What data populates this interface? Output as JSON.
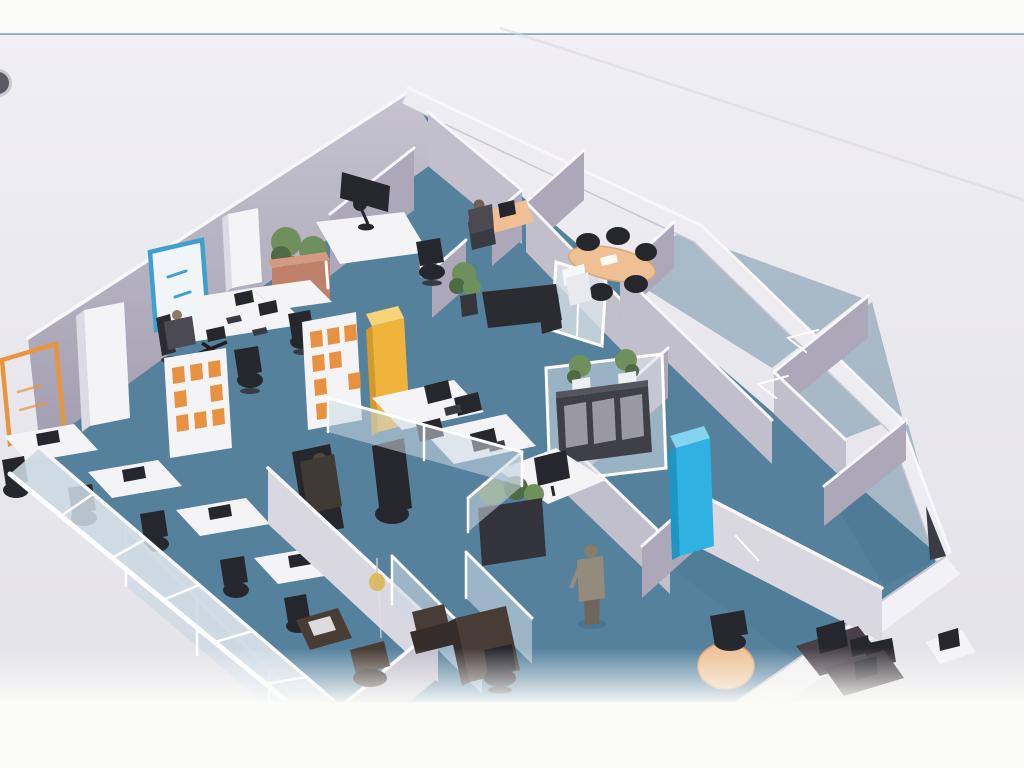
{
  "document": {
    "kind": "scanned-3d-office-floor-plan",
    "view": "aerial-perspective-dollhouse",
    "visible_text": [],
    "artifacts": [
      "binder-punch-hole-left-edge",
      "teal-rule-line-top",
      "diagonal-fold-crease-top-right",
      "white-scan-cutoff-bottom"
    ]
  },
  "palette": {
    "page": "#fbfbf9",
    "bandTop": "#f0eff3",
    "bandMid": "#e8e7ec",
    "bandBottom": "#e3e2e8",
    "tealLine": "#6fa5b5",
    "floor": "#55819d",
    "floorDark": "#47748f",
    "wall": "#aca8ba",
    "wallLight": "#c2bfcd",
    "wallLit": "#d9d7e0",
    "wallGradTop": "#c6c3cf",
    "wallGradBottom": "#a29eb0",
    "cap": "#f7f7f9",
    "glass": "#ccd9e2",
    "glassInt": "#dde6ec",
    "furnWhite": "#f4f4f6",
    "furnWhiteSide": "#dcdae3",
    "furnBlack": "#26262d",
    "furnBlack2": "#3a3a42",
    "furnBrown": "#473c36",
    "furnBrownDark": "#352d29",
    "yellowCab": "#f0b43c",
    "yellowCabTop": "#f8d478",
    "yellowCabSide": "#d29a2b",
    "blueCab": "#2fb2e2",
    "blueCabTop": "#85d4ef",
    "blueCabSide": "#1e96c4",
    "orangeBox": "#e89140",
    "orangeFrame": "#e8953f",
    "posterBlue": "#3f9fd1",
    "peach": "#eec094",
    "peachDark": "#dfa678",
    "plant": "#6f8f5c",
    "plantDark": "#4e6b44",
    "terra": "#bf8169",
    "terraLight": "#d49b82",
    "potDark": "#35353c",
    "personDark": "#4b4a52",
    "skin": "#8a7a66",
    "standBody": "#958b7c",
    "standLegs": "#6e665c",
    "standHead": "#8a7c6a",
    "punchHole": "#5a5a63",
    "crease": "#d8d7dd",
    "doorDark": "#3b3b44"
  },
  "scene": {
    "areas": [
      "open-office-left",
      "small-office-top-center",
      "meeting-room",
      "empty-rooms-right",
      "glass-cubicle-center",
      "corridor-center",
      "enclosed-rooms-bottom",
      "dark-furniture-room-bottom-right"
    ],
    "furniture": [
      "wall-tv",
      "desk-lamp-table",
      "office-chairs-black",
      "terracotta-planter-with-trees",
      "white-tall-cabinets",
      "blue-framed-poster",
      "orange-outline-whiteboard",
      "coat-stand",
      "desk-cluster-2x2-with-monitors",
      "shelving-units-orange-boxes",
      "yellow-tall-cabinet",
      "glass-cubicle-desks-4-monitors",
      "seated-person-open-office",
      "seated-person-cubicle",
      "seated-person-small-office",
      "standing-person-corridor",
      "oval-meeting-table-peach",
      "meeting-chairs-black",
      "glass-door-panel",
      "potted-plant",
      "black-sideboard-with-plants",
      "white-desk-with-monitor",
      "dark-planter-box",
      "cyan-tall-cabinet",
      "glass-facade-desk-row",
      "round-peach-table",
      "dark-brown-desks-and-chairs",
      "pendant-lamp",
      "door-swing-marks"
    ]
  }
}
